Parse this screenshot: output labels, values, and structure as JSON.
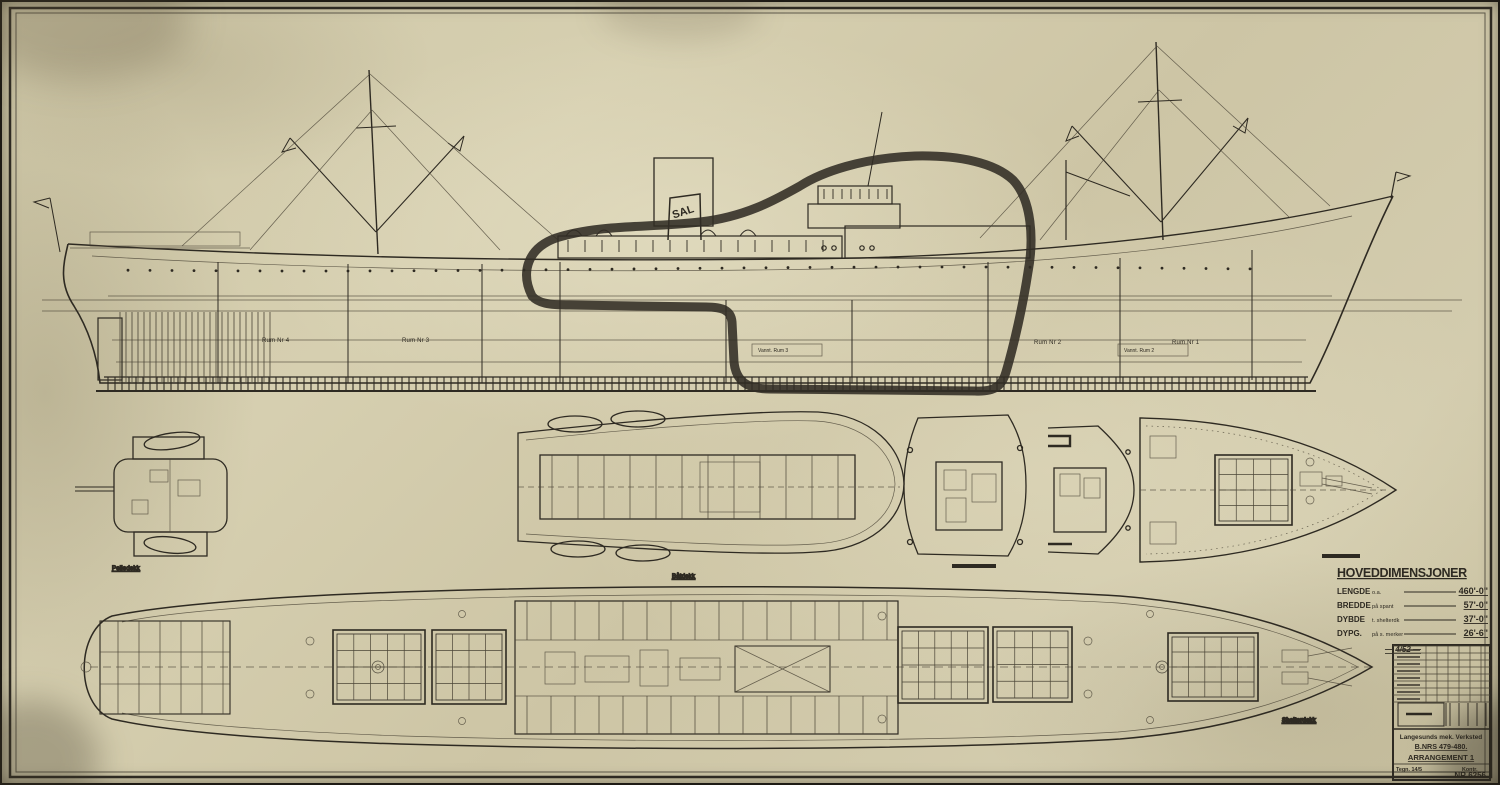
{
  "drawing": {
    "funnel_mark": "SAL",
    "profile": {
      "hold_labels": [
        "Rum Nr 4",
        "Rum Nr 3",
        "Rum Nr 2",
        "Rum Nr 1"
      ],
      "lower_hold_labels": [
        "Vannt. Rum 3",
        "Vannt. Rum 2"
      ]
    },
    "deck_plans": {
      "bridge_top_label": "Peiledekk",
      "boat_deck_label": "Båtdekk",
      "main_deck_label": "Shelterdekk"
    },
    "dimensions_table": {
      "title": "HOVEDDIMENSJONER",
      "rows": [
        {
          "label": "LENGDE",
          "qualifier": "o.a.",
          "value": "460'-0\""
        },
        {
          "label": "BREDDE",
          "qualifier": "på spant",
          "value": "57'-0\""
        },
        {
          "label": "DYBDE",
          "qualifier": "t. shelterdk",
          "value": "37'-0\""
        },
        {
          "label": "DYPG.",
          "qualifier": "på s. merker",
          "value": "26'-6\""
        }
      ],
      "note": "— 4/52 —"
    },
    "title_block": {
      "company": "Langesunds mek. Verksted",
      "build_numbers": "B.NRS 479-480.",
      "drawing_title": "ARRANGEMENT 1",
      "tegn_label": "Tegn. 14/5",
      "kontr_label": "Kontr.",
      "drawing_number": "NR 6256"
    }
  }
}
